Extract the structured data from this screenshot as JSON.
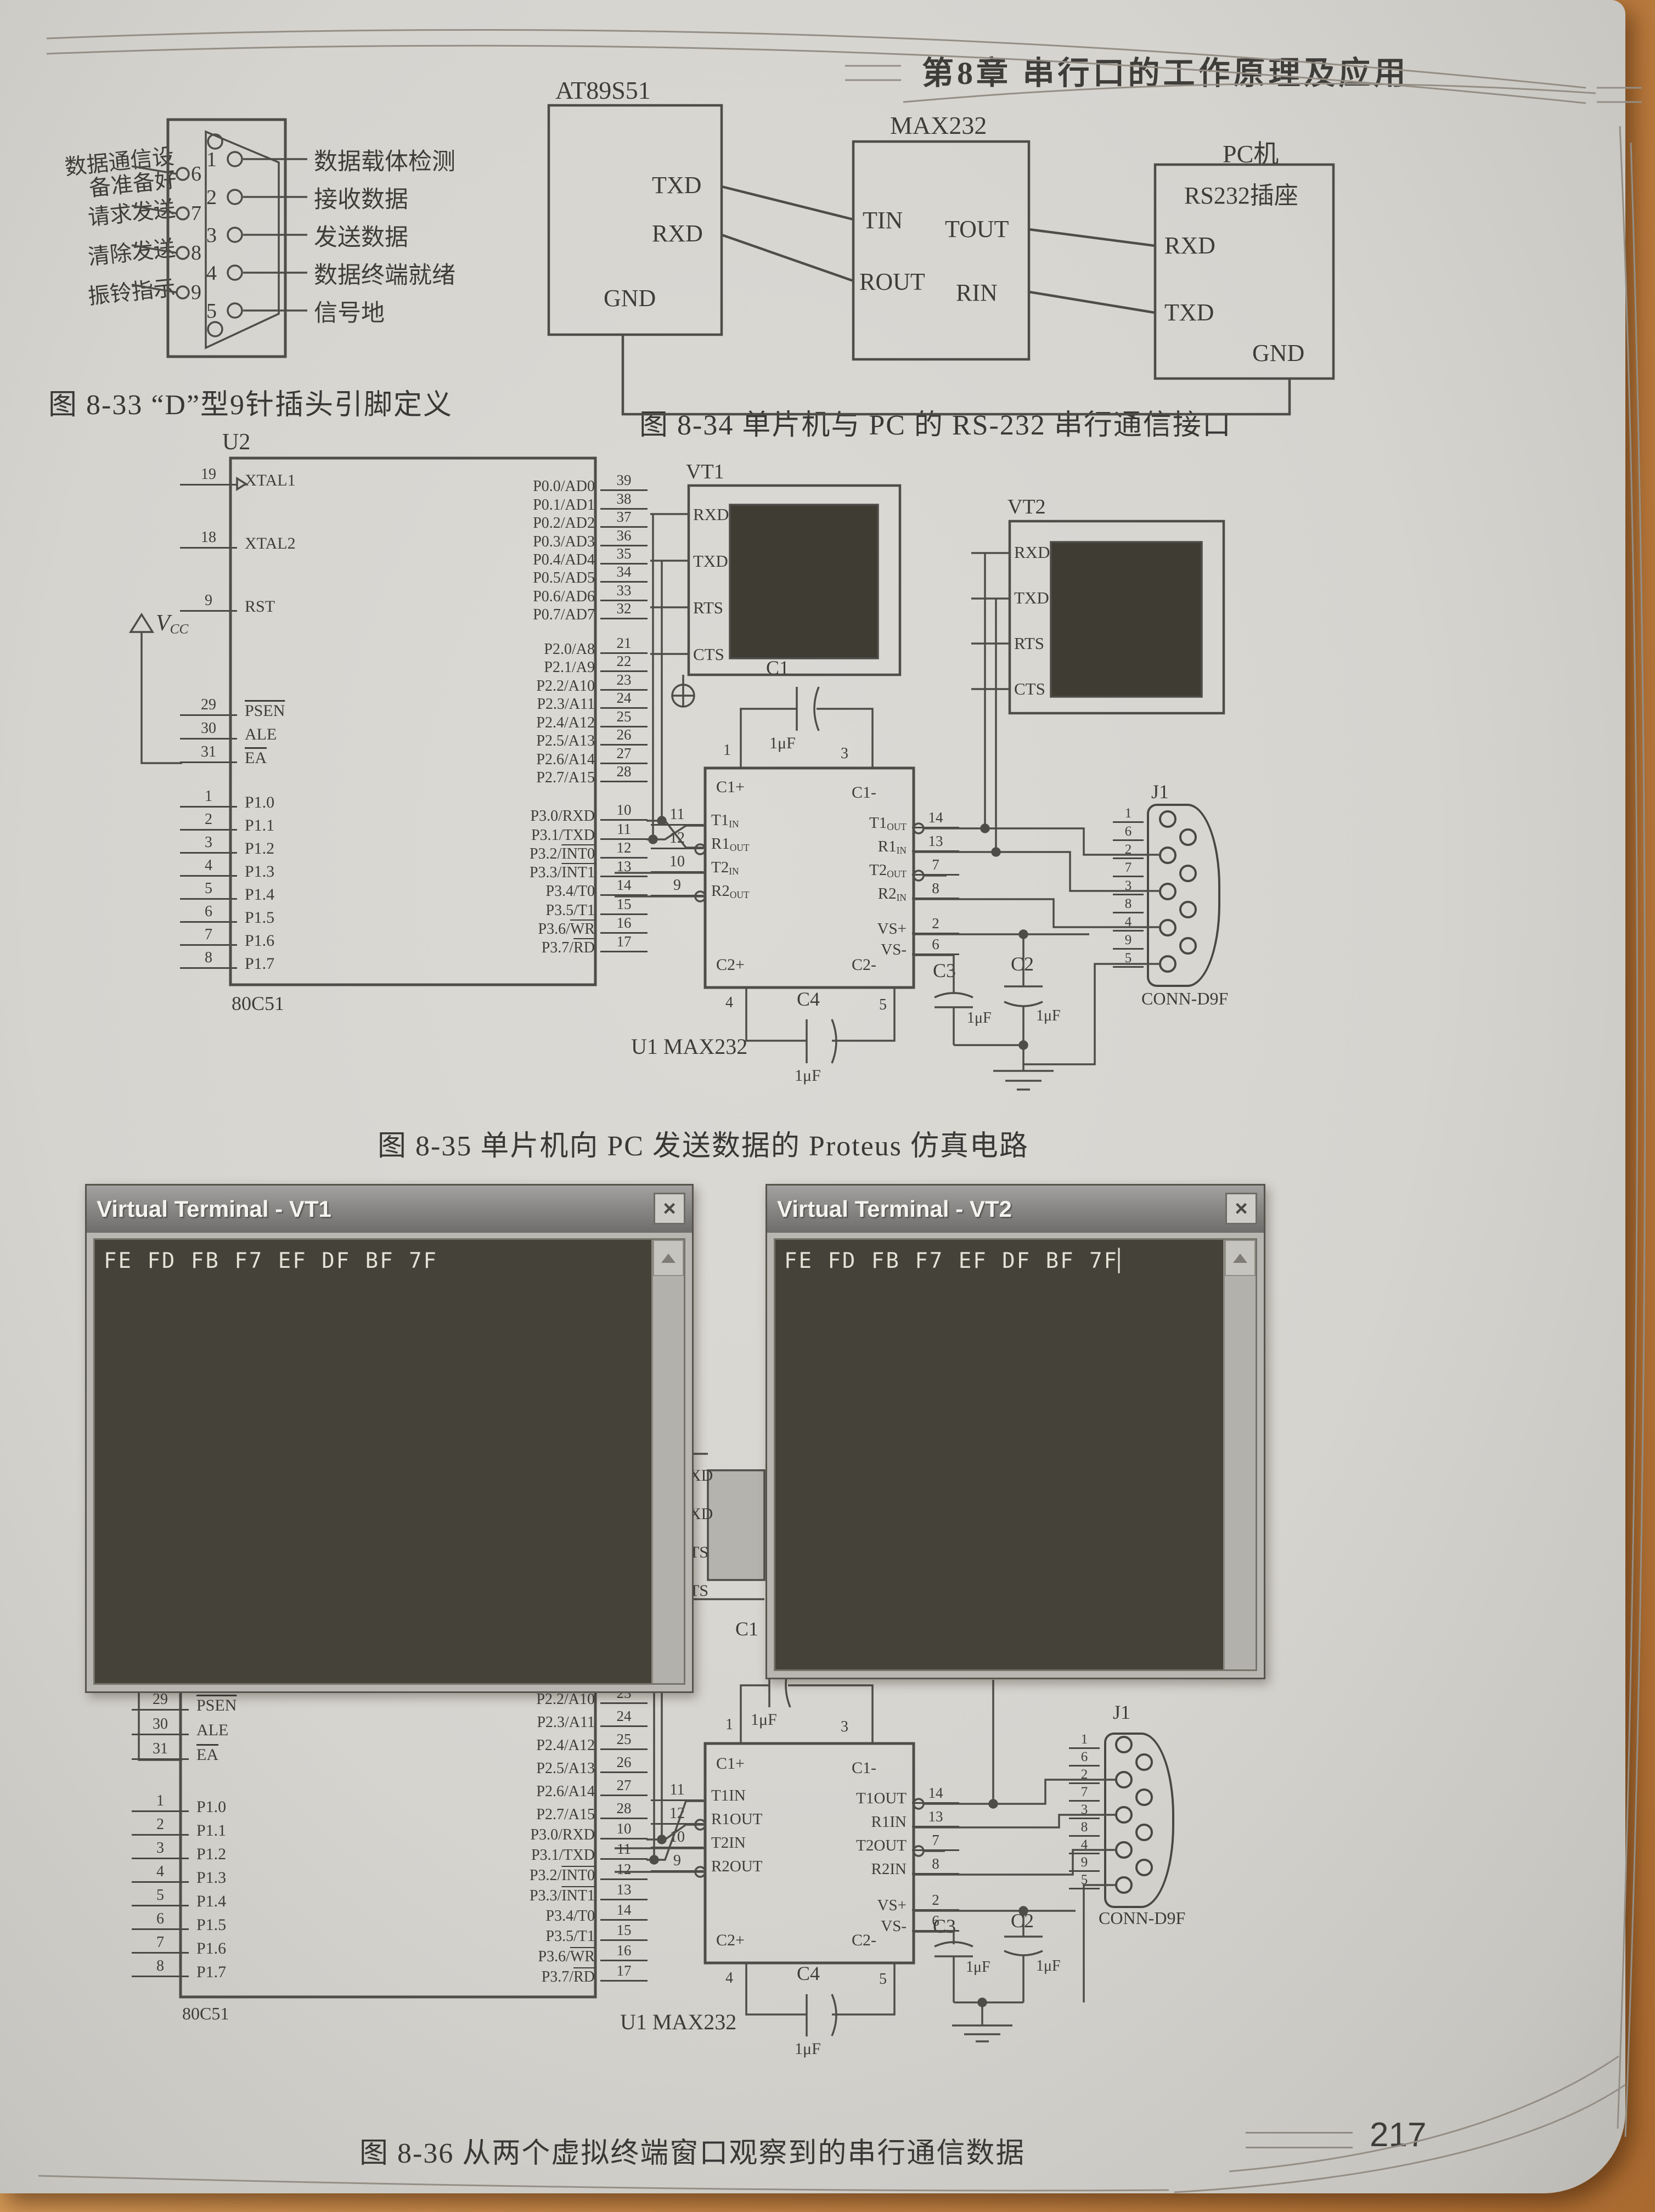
{
  "page": {
    "chapter_header": "第8章  串行口的工作原理及应用",
    "page_number": "217"
  },
  "fig833": {
    "caption": "图 8-33  “D”型9针插头引脚定义",
    "left_pins": [
      {
        "num": "6",
        "label": "数据通信设备准备好"
      },
      {
        "num": "7",
        "label": "请求发送"
      },
      {
        "num": "8",
        "label": "清除发送"
      },
      {
        "num": "9",
        "label": "振铃指示"
      }
    ],
    "right_pins": [
      {
        "num": "1",
        "label": "数据载体检测"
      },
      {
        "num": "2",
        "label": "接收数据"
      },
      {
        "num": "3",
        "label": "发送数据"
      },
      {
        "num": "4",
        "label": "数据终端就绪"
      },
      {
        "num": "5",
        "label": "信号地"
      }
    ]
  },
  "fig834": {
    "caption": "图 8-34  单片机与 PC 的 RS-232 串行通信接口",
    "mcu_title": "AT89S51",
    "mcu_txd": "TXD",
    "mcu_rxd": "RXD",
    "mcu_gnd": "GND",
    "max_title": "MAX232",
    "tin": "TIN",
    "tout": "TOUT",
    "rout": "ROUT",
    "rin": "RIN",
    "pc_title": "PC机",
    "pc_sub": "RS232插座",
    "pc_rxd": "RXD",
    "pc_txd": "TXD",
    "pc_gnd": "GND"
  },
  "fig835": {
    "caption": "图 8-35  单片机向 PC 发送数据的 Proteus 仿真电路",
    "u2": {
      "ref": "U2",
      "part": "80C51",
      "top_left": [
        {
          "num": "19",
          "pre": "XTAL1"
        },
        {
          "num": "18",
          "pre": "XTAL2"
        },
        {
          "num": "9",
          "pre": "RST"
        }
      ],
      "ctrl_left": [
        {
          "num": "29",
          "ov": "PSEN"
        },
        {
          "num": "30",
          "pre": "ALE"
        },
        {
          "num": "31",
          "ov": "EA"
        }
      ],
      "p1_left": [
        {
          "num": "1",
          "pre": "P1.0"
        },
        {
          "num": "2",
          "pre": "P1.1"
        },
        {
          "num": "3",
          "pre": "P1.2"
        },
        {
          "num": "4",
          "pre": "P1.3"
        },
        {
          "num": "5",
          "pre": "P1.4"
        },
        {
          "num": "6",
          "pre": "P1.5"
        },
        {
          "num": "7",
          "pre": "P1.6"
        },
        {
          "num": "8",
          "pre": "P1.7"
        }
      ],
      "p0_right": [
        {
          "num": "39",
          "pre": "P0.0/AD0"
        },
        {
          "num": "38",
          "pre": "P0.1/AD1"
        },
        {
          "num": "37",
          "pre": "P0.2/AD2"
        },
        {
          "num": "36",
          "pre": "P0.3/AD3"
        },
        {
          "num": "35",
          "pre": "P0.4/AD4"
        },
        {
          "num": "34",
          "pre": "P0.5/AD5"
        },
        {
          "num": "33",
          "pre": "P0.6/AD6"
        },
        {
          "num": "32",
          "pre": "P0.7/AD7"
        }
      ],
      "p2_right": [
        {
          "num": "21",
          "pre": "P2.0/A8"
        },
        {
          "num": "22",
          "pre": "P2.1/A9"
        },
        {
          "num": "23",
          "pre": "P2.2/A10"
        },
        {
          "num": "24",
          "pre": "P2.3/A11"
        },
        {
          "num": "25",
          "pre": "P2.4/A12"
        },
        {
          "num": "26",
          "pre": "P2.5/A13"
        },
        {
          "num": "27",
          "pre": "P2.6/A14"
        },
        {
          "num": "28",
          "pre": "P2.7/A15"
        }
      ],
      "p3_right": [
        {
          "num": "10",
          "pre": "P3.0/RXD"
        },
        {
          "num": "11",
          "pre": "P3.1/TXD"
        },
        {
          "num": "12",
          "pre": "P3.2/",
          "ov": "INT0"
        },
        {
          "num": "13",
          "pre": "P3.3/",
          "ov": "INT1"
        },
        {
          "num": "14",
          "pre": "P3.4/T0"
        },
        {
          "num": "15",
          "pre": "P3.5/T1"
        },
        {
          "num": "16",
          "pre": "P3.6/",
          "ov": "WR"
        },
        {
          "num": "17",
          "pre": "P3.7/",
          "ov": "RD"
        }
      ]
    },
    "vcc": {
      "v": "V",
      "sub": "CC"
    },
    "vt1": {
      "ref": "VT1",
      "pins": [
        "RXD",
        "TXD",
        "RTS",
        "CTS"
      ]
    },
    "vt2": {
      "ref": "VT2",
      "pins": [
        "RXD",
        "TXD",
        "RTS",
        "CTS"
      ]
    },
    "u1": {
      "ref": "U1  MAX232",
      "tl": "C1+",
      "tr": "C1-",
      "bl": "C2+",
      "br": "C2-",
      "left": [
        {
          "num": "11",
          "base": "T1",
          "sub": "IN"
        },
        {
          "num": "12",
          "base": "R1",
          "sub": "OUT"
        },
        {
          "num": "10",
          "base": "T2",
          "sub": "IN"
        },
        {
          "num": "9",
          "base": "R2",
          "sub": "OUT"
        }
      ],
      "right": [
        {
          "num": "14",
          "base": "T1",
          "sub": "OUT"
        },
        {
          "num": "13",
          "base": "R1",
          "sub": "IN"
        },
        {
          "num": "7",
          "base": "T2",
          "sub": "OUT"
        },
        {
          "num": "8",
          "base": "R2",
          "sub": "IN"
        }
      ],
      "vs": [
        {
          "num": "2",
          "base": "VS+"
        },
        {
          "num": "6",
          "base": "VS-"
        }
      ],
      "pin4": "4",
      "pin5": "5"
    },
    "c1": {
      "ref": "C1",
      "val": "1μF",
      "p1": "1",
      "p3": "3"
    },
    "c2": {
      "ref": "C2",
      "val": "1μF"
    },
    "c3": {
      "ref": "C3",
      "val": "1μF"
    },
    "c4": {
      "ref": "C4",
      "val": "1μF"
    },
    "j1": {
      "ref": "J1",
      "part": "CONN-D9F",
      "pins": [
        "1",
        "6",
        "2",
        "7",
        "3",
        "8",
        "4",
        "9",
        "5"
      ]
    }
  },
  "fig836": {
    "caption": "图 8-36  从两个虚拟终端窗口观察到的串行通信数据",
    "vt1_window": {
      "title": "Virtual Terminal - VT1",
      "content": "FE FD FB F7 EF DF BF 7F",
      "close": "×"
    },
    "vt2_window": {
      "title": "Virtual Terminal - VT2",
      "content": "FE FD FB F7 EF DF BF 7F",
      "cursor": "▏",
      "close": "×"
    },
    "sliver": {
      "pin1": "1",
      "labels": [
        "XD",
        "XD",
        "TS",
        "TS"
      ]
    },
    "chip": {
      "part": "80C51",
      "ctrl_left": [
        {
          "num": "29",
          "ov": "PSEN"
        },
        {
          "num": "30",
          "pre": "ALE"
        },
        {
          "num": "31",
          "ov": "EA"
        }
      ],
      "p1_left": [
        {
          "num": "1",
          "pre": "P1.0"
        },
        {
          "num": "2",
          "pre": "P1.1"
        },
        {
          "num": "3",
          "pre": "P1.2"
        },
        {
          "num": "4",
          "pre": "P1.3"
        },
        {
          "num": "5",
          "pre": "P1.4"
        },
        {
          "num": "6",
          "pre": "P1.5"
        },
        {
          "num": "7",
          "pre": "P1.6"
        },
        {
          "num": "8",
          "pre": "P1.7"
        }
      ],
      "p2_right": [
        {
          "num": "23",
          "pre": "P2.2/A10"
        },
        {
          "num": "24",
          "pre": "P2.3/A11"
        },
        {
          "num": "25",
          "pre": "P2.4/A12"
        },
        {
          "num": "26",
          "pre": "P2.5/A13"
        },
        {
          "num": "27",
          "pre": "P2.6/A14"
        },
        {
          "num": "28",
          "pre": "P2.7/A15"
        }
      ],
      "p3_right": [
        {
          "num": "10",
          "pre": "P3.0/RXD"
        },
        {
          "num": "11",
          "pre": "P3.1/TXD"
        },
        {
          "num": "12",
          "pre": "P3.2/",
          "ov": "INT0"
        },
        {
          "num": "13",
          "pre": "P3.3/",
          "ov": "INT1"
        },
        {
          "num": "14",
          "pre": "P3.4/T0"
        },
        {
          "num": "15",
          "pre": "P3.5/T1"
        },
        {
          "num": "16",
          "pre": "P3.6/",
          "ov": "WR"
        },
        {
          "num": "17",
          "pre": "P3.7/",
          "ov": "RD"
        }
      ]
    },
    "u1": {
      "ref": "U1  MAX232",
      "tl": "C1+",
      "tr": "C1-",
      "bl": "C2+",
      "br": "C2-",
      "left": [
        {
          "num": "11",
          "base": "T1IN"
        },
        {
          "num": "12",
          "base": "R1OUT"
        },
        {
          "num": "10",
          "base": "T2IN"
        },
        {
          "num": "9",
          "base": "R2OUT"
        }
      ],
      "right": [
        {
          "num": "14",
          "base": "T1OUT"
        },
        {
          "num": "13",
          "base": "R1IN"
        },
        {
          "num": "7",
          "base": "T2OUT"
        },
        {
          "num": "8",
          "base": "R2IN"
        }
      ],
      "vs": [
        {
          "num": "2",
          "base": "VS+"
        },
        {
          "num": "6",
          "base": "VS-"
        }
      ],
      "pin4": "4",
      "pin5": "5"
    },
    "c1": {
      "ref": "C1",
      "val": "1μF",
      "p1": "1",
      "p3": "3"
    },
    "c2": {
      "ref": "C2",
      "val": "1μF"
    },
    "c3": {
      "ref": "C3",
      "val": "1μF"
    },
    "c4": {
      "ref": "C4",
      "val": "1μF"
    },
    "j1": {
      "ref": "J1",
      "part": "CONN-D9F",
      "pins": [
        "1",
        "6",
        "2",
        "7",
        "3",
        "8",
        "4",
        "9",
        "5"
      ]
    }
  }
}
